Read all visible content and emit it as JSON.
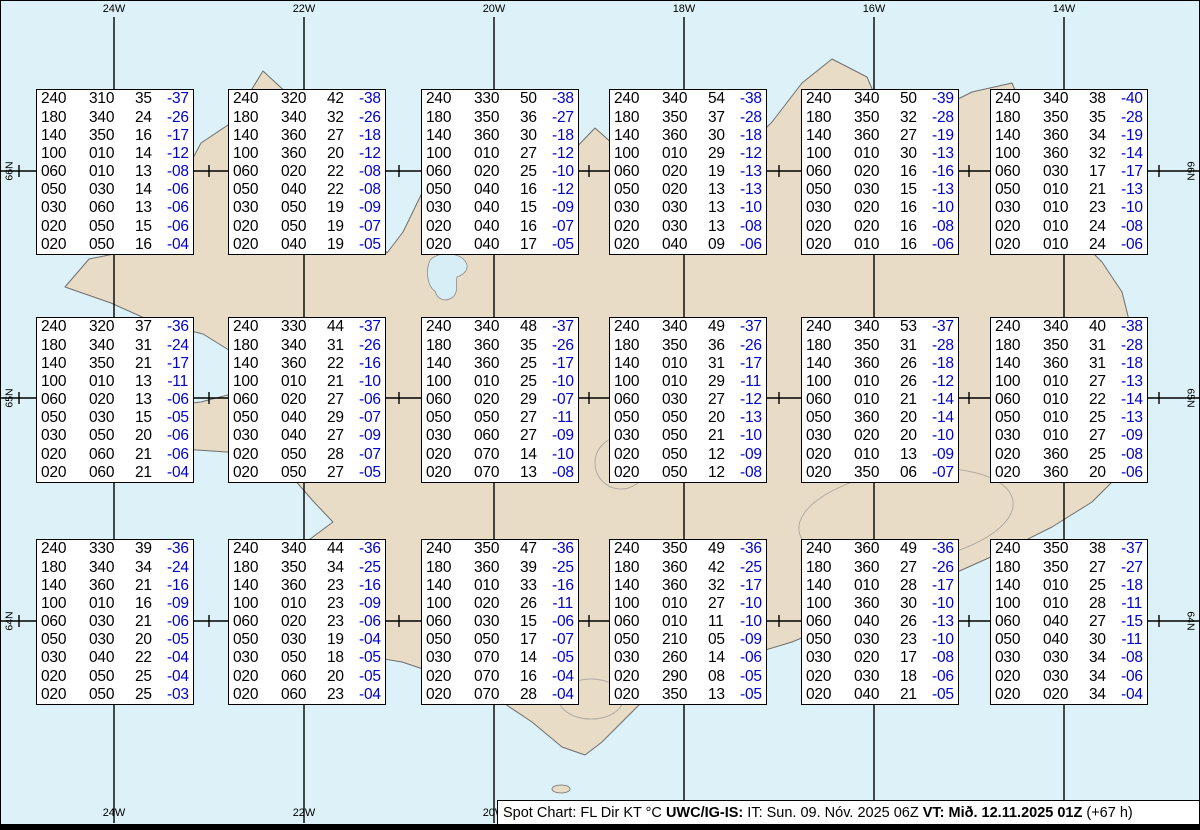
{
  "map": {
    "region_name": "Iceland",
    "ocean_color": "#ddf2f8",
    "land_color": "#e8dcc7",
    "coast_color": "#6e6e6e",
    "temp_color": "#0000cc"
  },
  "grid": {
    "top_lon_labels": [
      "24W",
      "22W",
      "20W",
      "18W",
      "16W",
      "14W"
    ],
    "bottom_lon_labels": [
      "24W",
      "22W",
      "20W",
      "18W",
      "16W",
      "14W"
    ],
    "left_lat_labels": [
      "66N",
      "65N",
      "64N"
    ],
    "right_lat_labels": [
      "66N",
      "65N",
      "64N"
    ]
  },
  "spot_boxes": [
    {
      "rows": [
        [
          "240",
          "310",
          "35",
          "-37"
        ],
        [
          "180",
          "340",
          "24",
          "-26"
        ],
        [
          "140",
          "350",
          "16",
          "-17"
        ],
        [
          "100",
          "010",
          "14",
          "-12"
        ],
        [
          "060",
          "010",
          "13",
          "-08"
        ],
        [
          "050",
          "030",
          "14",
          "-06"
        ],
        [
          "030",
          "060",
          "13",
          "-06"
        ],
        [
          "020",
          "050",
          "15",
          "-06"
        ],
        [
          "020",
          "050",
          "16",
          "-04"
        ]
      ]
    },
    {
      "rows": [
        [
          "240",
          "320",
          "42",
          "-38"
        ],
        [
          "180",
          "340",
          "32",
          "-26"
        ],
        [
          "140",
          "360",
          "27",
          "-18"
        ],
        [
          "100",
          "360",
          "20",
          "-12"
        ],
        [
          "060",
          "020",
          "22",
          "-08"
        ],
        [
          "050",
          "040",
          "22",
          "-08"
        ],
        [
          "030",
          "050",
          "19",
          "-09"
        ],
        [
          "020",
          "050",
          "19",
          "-07"
        ],
        [
          "020",
          "040",
          "19",
          "-05"
        ]
      ]
    },
    {
      "rows": [
        [
          "240",
          "330",
          "50",
          "-38"
        ],
        [
          "180",
          "350",
          "36",
          "-27"
        ],
        [
          "140",
          "360",
          "30",
          "-18"
        ],
        [
          "100",
          "010",
          "27",
          "-12"
        ],
        [
          "060",
          "020",
          "25",
          "-10"
        ],
        [
          "050",
          "040",
          "16",
          "-12"
        ],
        [
          "030",
          "040",
          "15",
          "-09"
        ],
        [
          "020",
          "040",
          "16",
          "-07"
        ],
        [
          "020",
          "040",
          "17",
          "-05"
        ]
      ]
    },
    {
      "rows": [
        [
          "240",
          "340",
          "54",
          "-38"
        ],
        [
          "180",
          "350",
          "37",
          "-28"
        ],
        [
          "140",
          "360",
          "30",
          "-18"
        ],
        [
          "100",
          "010",
          "29",
          "-12"
        ],
        [
          "060",
          "020",
          "19",
          "-13"
        ],
        [
          "050",
          "020",
          "13",
          "-13"
        ],
        [
          "030",
          "030",
          "13",
          "-10"
        ],
        [
          "020",
          "030",
          "13",
          "-08"
        ],
        [
          "020",
          "040",
          "09",
          "-06"
        ]
      ]
    },
    {
      "rows": [
        [
          "240",
          "340",
          "50",
          "-39"
        ],
        [
          "180",
          "350",
          "32",
          "-28"
        ],
        [
          "140",
          "360",
          "27",
          "-19"
        ],
        [
          "100",
          "010",
          "30",
          "-13"
        ],
        [
          "060",
          "020",
          "16",
          "-16"
        ],
        [
          "050",
          "030",
          "15",
          "-13"
        ],
        [
          "030",
          "020",
          "16",
          "-10"
        ],
        [
          "020",
          "020",
          "16",
          "-08"
        ],
        [
          "020",
          "010",
          "16",
          "-06"
        ]
      ]
    },
    {
      "rows": [
        [
          "240",
          "340",
          "38",
          "-40"
        ],
        [
          "180",
          "350",
          "35",
          "-28"
        ],
        [
          "140",
          "360",
          "34",
          "-19"
        ],
        [
          "100",
          "360",
          "32",
          "-14"
        ],
        [
          "060",
          "030",
          "17",
          "-17"
        ],
        [
          "050",
          "010",
          "21",
          "-13"
        ],
        [
          "030",
          "010",
          "23",
          "-10"
        ],
        [
          "020",
          "010",
          "24",
          "-08"
        ],
        [
          "020",
          "010",
          "24",
          "-06"
        ]
      ]
    },
    {
      "rows": [
        [
          "240",
          "320",
          "37",
          "-36"
        ],
        [
          "180",
          "340",
          "31",
          "-24"
        ],
        [
          "140",
          "350",
          "21",
          "-17"
        ],
        [
          "100",
          "010",
          "13",
          "-11"
        ],
        [
          "060",
          "020",
          "13",
          "-06"
        ],
        [
          "050",
          "030",
          "15",
          "-05"
        ],
        [
          "030",
          "050",
          "20",
          "-06"
        ],
        [
          "020",
          "060",
          "21",
          "-06"
        ],
        [
          "020",
          "060",
          "21",
          "-04"
        ]
      ]
    },
    {
      "rows": [
        [
          "240",
          "330",
          "44",
          "-37"
        ],
        [
          "180",
          "340",
          "31",
          "-26"
        ],
        [
          "140",
          "360",
          "22",
          "-16"
        ],
        [
          "100",
          "010",
          "21",
          "-10"
        ],
        [
          "060",
          "020",
          "27",
          "-06"
        ],
        [
          "050",
          "040",
          "29",
          "-07"
        ],
        [
          "030",
          "040",
          "27",
          "-09"
        ],
        [
          "020",
          "050",
          "28",
          "-07"
        ],
        [
          "020",
          "050",
          "27",
          "-05"
        ]
      ]
    },
    {
      "rows": [
        [
          "240",
          "340",
          "48",
          "-37"
        ],
        [
          "180",
          "360",
          "35",
          "-26"
        ],
        [
          "140",
          "360",
          "25",
          "-17"
        ],
        [
          "100",
          "010",
          "25",
          "-10"
        ],
        [
          "060",
          "020",
          "29",
          "-07"
        ],
        [
          "050",
          "050",
          "27",
          "-11"
        ],
        [
          "030",
          "060",
          "27",
          "-09"
        ],
        [
          "020",
          "070",
          "14",
          "-10"
        ],
        [
          "020",
          "070",
          "13",
          "-08"
        ]
      ]
    },
    {
      "rows": [
        [
          "240",
          "340",
          "49",
          "-37"
        ],
        [
          "180",
          "350",
          "36",
          "-26"
        ],
        [
          "140",
          "010",
          "31",
          "-17"
        ],
        [
          "100",
          "010",
          "29",
          "-11"
        ],
        [
          "060",
          "030",
          "27",
          "-12"
        ],
        [
          "050",
          "050",
          "20",
          "-13"
        ],
        [
          "030",
          "050",
          "21",
          "-10"
        ],
        [
          "020",
          "050",
          "12",
          "-09"
        ],
        [
          "020",
          "050",
          "12",
          "-08"
        ]
      ]
    },
    {
      "rows": [
        [
          "240",
          "340",
          "53",
          "-37"
        ],
        [
          "180",
          "350",
          "31",
          "-28"
        ],
        [
          "140",
          "360",
          "26",
          "-18"
        ],
        [
          "100",
          "010",
          "26",
          "-12"
        ],
        [
          "060",
          "010",
          "21",
          "-14"
        ],
        [
          "050",
          "360",
          "20",
          "-14"
        ],
        [
          "030",
          "020",
          "20",
          "-10"
        ],
        [
          "020",
          "010",
          "13",
          "-09"
        ],
        [
          "020",
          "350",
          "06",
          "-07"
        ]
      ]
    },
    {
      "rows": [
        [
          "240",
          "340",
          "40",
          "-38"
        ],
        [
          "180",
          "350",
          "31",
          "-28"
        ],
        [
          "140",
          "360",
          "31",
          "-18"
        ],
        [
          "100",
          "010",
          "27",
          "-13"
        ],
        [
          "060",
          "010",
          "22",
          "-14"
        ],
        [
          "050",
          "010",
          "25",
          "-13"
        ],
        [
          "030",
          "010",
          "27",
          "-09"
        ],
        [
          "020",
          "360",
          "25",
          "-08"
        ],
        [
          "020",
          "360",
          "20",
          "-06"
        ]
      ]
    },
    {
      "rows": [
        [
          "240",
          "330",
          "39",
          "-36"
        ],
        [
          "180",
          "340",
          "34",
          "-24"
        ],
        [
          "140",
          "360",
          "21",
          "-16"
        ],
        [
          "100",
          "010",
          "16",
          "-09"
        ],
        [
          "060",
          "030",
          "21",
          "-06"
        ],
        [
          "050",
          "030",
          "20",
          "-05"
        ],
        [
          "030",
          "040",
          "22",
          "-04"
        ],
        [
          "020",
          "050",
          "25",
          "-04"
        ],
        [
          "020",
          "050",
          "25",
          "-03"
        ]
      ]
    },
    {
      "rows": [
        [
          "240",
          "340",
          "44",
          "-36"
        ],
        [
          "180",
          "350",
          "34",
          "-25"
        ],
        [
          "140",
          "360",
          "23",
          "-16"
        ],
        [
          "100",
          "010",
          "23",
          "-09"
        ],
        [
          "060",
          "020",
          "23",
          "-06"
        ],
        [
          "050",
          "030",
          "19",
          "-04"
        ],
        [
          "030",
          "050",
          "18",
          "-05"
        ],
        [
          "020",
          "060",
          "20",
          "-05"
        ],
        [
          "020",
          "060",
          "23",
          "-04"
        ]
      ]
    },
    {
      "rows": [
        [
          "240",
          "350",
          "47",
          "-36"
        ],
        [
          "180",
          "360",
          "39",
          "-25"
        ],
        [
          "140",
          "010",
          "33",
          "-16"
        ],
        [
          "100",
          "020",
          "26",
          "-11"
        ],
        [
          "060",
          "030",
          "15",
          "-06"
        ],
        [
          "050",
          "050",
          "17",
          "-07"
        ],
        [
          "030",
          "070",
          "14",
          "-05"
        ],
        [
          "020",
          "070",
          "16",
          "-04"
        ],
        [
          "020",
          "070",
          "28",
          "-04"
        ]
      ]
    },
    {
      "rows": [
        [
          "240",
          "350",
          "49",
          "-36"
        ],
        [
          "180",
          "360",
          "42",
          "-25"
        ],
        [
          "140",
          "360",
          "32",
          "-17"
        ],
        [
          "100",
          "010",
          "27",
          "-10"
        ],
        [
          "060",
          "010",
          "11",
          "-10"
        ],
        [
          "050",
          "210",
          "05",
          "-09"
        ],
        [
          "030",
          "260",
          "14",
          "-06"
        ],
        [
          "020",
          "290",
          "08",
          "-05"
        ],
        [
          "020",
          "350",
          "13",
          "-05"
        ]
      ]
    },
    {
      "rows": [
        [
          "240",
          "360",
          "49",
          "-36"
        ],
        [
          "180",
          "360",
          "27",
          "-26"
        ],
        [
          "140",
          "010",
          "28",
          "-17"
        ],
        [
          "100",
          "360",
          "30",
          "-10"
        ],
        [
          "060",
          "040",
          "26",
          "-13"
        ],
        [
          "050",
          "030",
          "23",
          "-10"
        ],
        [
          "030",
          "020",
          "17",
          "-08"
        ],
        [
          "020",
          "030",
          "18",
          "-06"
        ],
        [
          "020",
          "040",
          "21",
          "-05"
        ]
      ]
    },
    {
      "rows": [
        [
          "240",
          "350",
          "38",
          "-37"
        ],
        [
          "180",
          "350",
          "27",
          "-27"
        ],
        [
          "140",
          "010",
          "25",
          "-18"
        ],
        [
          "100",
          "010",
          "28",
          "-11"
        ],
        [
          "060",
          "040",
          "27",
          "-15"
        ],
        [
          "050",
          "040",
          "30",
          "-11"
        ],
        [
          "030",
          "030",
          "34",
          "-08"
        ],
        [
          "020",
          "030",
          "34",
          "-06"
        ],
        [
          "020",
          "020",
          "34",
          "-04"
        ]
      ]
    }
  ],
  "status_bar": {
    "prefix": "Spot Chart: FL Dir KT °C ",
    "source_bold": "UWC/IG-IS:",
    "issue_time": " IT: Sun. 09. Nóv. 2025 06Z ",
    "valid_time_bold": "VT: Mið. 12.11.2025 01Z",
    "suffix": " (+67 h)"
  }
}
